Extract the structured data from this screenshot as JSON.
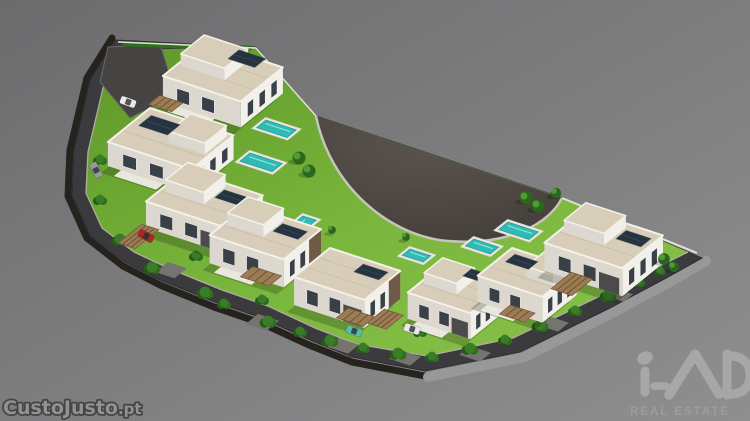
{
  "meta": {
    "alt": "3D aerial render of a crescent-shaped residential development with white villas, pools, lawns and a dark perimeter road on a plain gray background"
  },
  "watermarks": {
    "listing_site": "CustoJusto",
    "listing_site_tld": ".pt",
    "brand": "iad",
    "brand_subtitle": "REAL ESTATE"
  },
  "colors": {
    "bg_top": "#6c6c6e",
    "bg_bottom": "#8f8f90",
    "soil": "#26221d",
    "slab": "#98989a",
    "road": "#3b3b3d",
    "curb": "#aeaca3",
    "grass_dark": "#5e9728",
    "grass_mid": "#79b53c",
    "grass_light": "#8ac24a",
    "plaza_center": "#5b544e",
    "plaza_edge": "#423d39",
    "plaza_curb": "#c8c4bb",
    "wall_light": "#f2f0eb",
    "wall_shade": "#dcd7cf",
    "roof": "#d8cdb8",
    "roof_edge": "#f4f1e9",
    "roof_line": "#c2b69e",
    "window": "#394048",
    "garage": "#4b4b4d",
    "accent_wood": "#6e5a47",
    "panel": "#273440",
    "panel_line": "#3c5164",
    "pergola": "#9d7c55",
    "pergola_slat": "#6f5334",
    "pool_water": "#2fbab4",
    "pool_deck": "#e9e6df",
    "pool_light": "#8fe0da",
    "tree_dark": "#2c661d",
    "tree_light": "#4f9c33",
    "bush": "#2f6e20",
    "bush_dark": "#265c18",
    "bush_light": "#3a7d28",
    "shadow": "rgba(25,35,15,0.25)",
    "apron": "#76746e",
    "parking": "#454443",
    "wall_line": "#e3e0d8",
    "watermark_fill": "#929292",
    "watermark_stroke": "#454545",
    "logo": "#a7a7a7",
    "logo_sub": "#9d9d9d"
  },
  "scene": {
    "outer": [
      [
        115,
        40
      ],
      [
        90,
        80
      ],
      [
        74,
        150
      ],
      [
        72,
        195
      ],
      [
        90,
        235
      ],
      [
        125,
        262
      ],
      [
        160,
        280
      ],
      [
        215,
        302
      ],
      [
        262,
        318
      ],
      [
        310,
        340
      ],
      [
        352,
        357
      ],
      [
        425,
        371
      ],
      [
        520,
        352
      ],
      [
        610,
        308
      ],
      [
        668,
        277
      ],
      [
        702,
        258
      ],
      [
        560,
        197
      ],
      [
        316,
        116
      ],
      [
        256,
        47
      ]
    ],
    "inner": [
      [
        127,
        50
      ],
      [
        103,
        88
      ],
      [
        88,
        152
      ],
      [
        86,
        193
      ],
      [
        102,
        228
      ],
      [
        134,
        252
      ],
      [
        168,
        268
      ],
      [
        222,
        290
      ],
      [
        268,
        306
      ],
      [
        315,
        328
      ],
      [
        356,
        344
      ],
      [
        427,
        356
      ],
      [
        513,
        338
      ],
      [
        598,
        297
      ],
      [
        654,
        269
      ],
      [
        688,
        252
      ],
      [
        560,
        197
      ],
      [
        316,
        116
      ],
      [
        256,
        47
      ]
    ],
    "soil": [
      [
        112,
        38
      ],
      [
        87,
        78
      ],
      [
        70,
        150
      ],
      [
        68,
        196
      ],
      [
        87,
        238
      ],
      [
        123,
        266
      ],
      [
        160,
        285
      ],
      [
        214,
        307
      ],
      [
        261,
        323
      ],
      [
        309,
        345
      ],
      [
        352,
        362
      ],
      [
        425,
        376
      ]
    ],
    "slab": [
      [
        428,
        377
      ],
      [
        525,
        357
      ],
      [
        612,
        313
      ],
      [
        672,
        281
      ],
      [
        706,
        261
      ]
    ],
    "plaza_path": "M316,116 L562,198 C549,224 508,246 448,241 C389,236 330,186 316,116 Z",
    "plaza_curb_path": "M562,198 C549,224 508,246 448,241 C389,236 330,186 316,116",
    "walls": [
      [
        [
          118,
          42
        ],
        [
          256,
          48
        ],
        [
          316,
          116
        ]
      ],
      [
        [
          562,
          198
        ],
        [
          697,
          253
        ]
      ]
    ],
    "parking": [
      [
        108,
        47
      ],
      [
        160,
        44
      ],
      [
        176,
        95
      ],
      [
        130,
        118
      ],
      [
        100,
        82
      ]
    ],
    "hedge": [
      [
        125,
        44
      ],
      [
        250,
        48
      ]
    ],
    "aprons": [
      {
        "x": 168,
        "y": 262,
        "a": 20,
        "b": 16
      },
      {
        "x": 258,
        "y": 314,
        "a": 22,
        "b": 16
      },
      {
        "x": 338,
        "y": 338,
        "a": 22,
        "b": 14
      },
      {
        "x": 400,
        "y": 350,
        "a": 22,
        "b": 14
      },
      {
        "x": 470,
        "y": 346,
        "a": 22,
        "b": 14
      },
      {
        "x": 548,
        "y": 316,
        "a": 22,
        "b": 14
      },
      {
        "x": 614,
        "y": 288,
        "a": 20,
        "b": 12
      }
    ],
    "villas": [
      {
        "x": 205,
        "y": 42,
        "a": 82,
        "b": 54,
        "h": 26,
        "up": {
          "da": 4,
          "db": 6,
          "a": 46,
          "b": 30,
          "h": 12
        },
        "panels": [
          {
            "da": 44,
            "db": 10,
            "a": 28,
            "b": 14
          }
        ],
        "pergola": {
          "da": 0,
          "db": 58,
          "a": 24,
          "b": 14
        },
        "garage": false,
        "accent": false,
        "patio": true
      },
      {
        "x": 150,
        "y": 108,
        "a": 88,
        "b": 54,
        "h": 24,
        "up": {
          "da": 46,
          "db": 4,
          "a": 38,
          "b": 28,
          "h": 11
        },
        "panels": [
          {
            "da": 8,
            "db": 8,
            "a": 30,
            "b": 16
          }
        ],
        "pergola": null,
        "garage": false,
        "accent": false,
        "patio": true
      },
      {
        "x": 185,
        "y": 170,
        "a": 82,
        "b": 50,
        "h": 26,
        "up": {
          "da": 6,
          "db": 4,
          "a": 40,
          "b": 28,
          "h": 12
        },
        "panels": [
          {
            "da": 48,
            "db": 8,
            "a": 26,
            "b": 12
          }
        ],
        "pergola": {
          "da": 2,
          "db": 58,
          "a": 18,
          "b": 30
        },
        "garage": true,
        "accent": false,
        "patio": false
      },
      {
        "x": 247,
        "y": 205,
        "a": 78,
        "b": 48,
        "h": 28,
        "up": {
          "da": 4,
          "db": 4,
          "a": 38,
          "b": 26,
          "h": 12
        },
        "panels": [
          {
            "da": 44,
            "db": 8,
            "a": 26,
            "b": 12
          }
        ],
        "pergola": {
          "da": 44,
          "db": 46,
          "a": 30,
          "b": 16
        },
        "garage": false,
        "accent": true,
        "patio": true
      },
      {
        "x": 330,
        "y": 248,
        "a": 74,
        "b": 46,
        "h": 28,
        "panels": [
          {
            "da": 40,
            "db": 6,
            "a": 26,
            "b": 12
          }
        ],
        "pergola": {
          "da": 52,
          "db": 40,
          "a": 28,
          "b": 15
        },
        "garage": true,
        "accent": true,
        "patio": false
      },
      {
        "x": 442,
        "y": 265,
        "a": 66,
        "b": 44,
        "h": 26,
        "up": {
          "da": 4,
          "db": 4,
          "a": 34,
          "b": 24,
          "h": 11
        },
        "panels": [
          {
            "da": 36,
            "db": 6,
            "a": 22,
            "b": 11
          }
        ],
        "pergola": {
          "da": -18,
          "db": 52,
          "a": 20,
          "b": 22
        },
        "garage": true,
        "accent": false,
        "patio": true
      },
      {
        "x": 512,
        "y": 248,
        "a": 68,
        "b": 44,
        "h": 26,
        "up": {
          "da": 38,
          "db": 4,
          "a": 28,
          "b": 24,
          "h": 11
        },
        "panels": [
          {
            "da": 8,
            "db": 6,
            "a": 24,
            "b": 12
          }
        ],
        "pergola": {
          "da": 36,
          "db": 46,
          "a": 26,
          "b": 14
        },
        "garage": false,
        "accent": false,
        "patio": true
      },
      {
        "x": 585,
        "y": 210,
        "a": 82,
        "b": 52,
        "h": 28,
        "up": {
          "da": 5,
          "db": 5,
          "a": 42,
          "b": 28,
          "h": 12
        },
        "panels": [
          {
            "da": 50,
            "db": 8,
            "a": 26,
            "b": 13
          }
        ],
        "pergola": {
          "da": 30,
          "db": 54,
          "a": 22,
          "b": 26
        },
        "garage": true,
        "accent": false,
        "patio": false
      }
    ],
    "pools": [
      {
        "x": 266,
        "y": 120,
        "a": 32,
        "b": 12
      },
      {
        "x": 250,
        "y": 153,
        "a": 34,
        "b": 13
      },
      {
        "x": 303,
        "y": 216,
        "a": 14,
        "b": 26
      },
      {
        "x": 410,
        "y": 249,
        "a": 22,
        "b": 10
      },
      {
        "x": 474,
        "y": 239,
        "a": 26,
        "b": 11
      },
      {
        "x": 508,
        "y": 222,
        "a": 32,
        "b": 12
      }
    ],
    "trees": [
      {
        "x": 299,
        "y": 158,
        "s": 1
      },
      {
        "x": 309,
        "y": 171,
        "s": 1
      },
      {
        "x": 526,
        "y": 198,
        "s": 1
      },
      {
        "x": 538,
        "y": 206,
        "s": 1
      },
      {
        "x": 556,
        "y": 193,
        "s": 0.8
      },
      {
        "x": 664,
        "y": 259,
        "s": 0.9
      },
      {
        "x": 674,
        "y": 267,
        "s": 0.8
      },
      {
        "x": 332,
        "y": 230,
        "s": 0.6
      },
      {
        "x": 406,
        "y": 237,
        "s": 0.6
      }
    ],
    "bushes": [
      [
        205,
        293,
        6
      ],
      [
        224,
        304,
        5
      ],
      [
        268,
        322,
        6
      ],
      [
        300,
        332,
        5
      ],
      [
        330,
        341,
        6
      ],
      [
        363,
        348,
        5
      ],
      [
        398,
        354,
        6
      ],
      [
        432,
        357,
        5
      ],
      [
        470,
        349,
        6
      ],
      [
        505,
        340,
        5
      ],
      [
        540,
        326,
        6
      ],
      [
        575,
        311,
        5
      ],
      [
        608,
        296,
        6
      ],
      [
        638,
        282,
        5
      ],
      [
        660,
        271,
        4
      ],
      [
        100,
        160,
        5
      ],
      [
        100,
        200,
        5
      ],
      [
        120,
        240,
        6
      ],
      [
        152,
        268,
        6
      ],
      [
        196,
        256,
        5
      ],
      [
        262,
        300,
        5
      ],
      [
        345,
        315,
        5
      ],
      [
        420,
        332,
        5
      ],
      [
        500,
        312,
        5
      ],
      [
        570,
        288,
        5
      ],
      [
        640,
        262,
        4
      ]
    ],
    "cars": [
      {
        "x": 146,
        "y": 236,
        "r": 28,
        "c": "#a72b20"
      },
      {
        "x": 354,
        "y": 331,
        "r": 20,
        "c": "#5fb9ad"
      },
      {
        "x": 128,
        "y": 102,
        "r": 20,
        "c": "#e9e9e7"
      },
      {
        "x": 96,
        "y": 170,
        "r": 62,
        "c": "#97999b"
      },
      {
        "x": 412,
        "y": 329,
        "r": 18,
        "c": "#eceae6"
      }
    ]
  }
}
